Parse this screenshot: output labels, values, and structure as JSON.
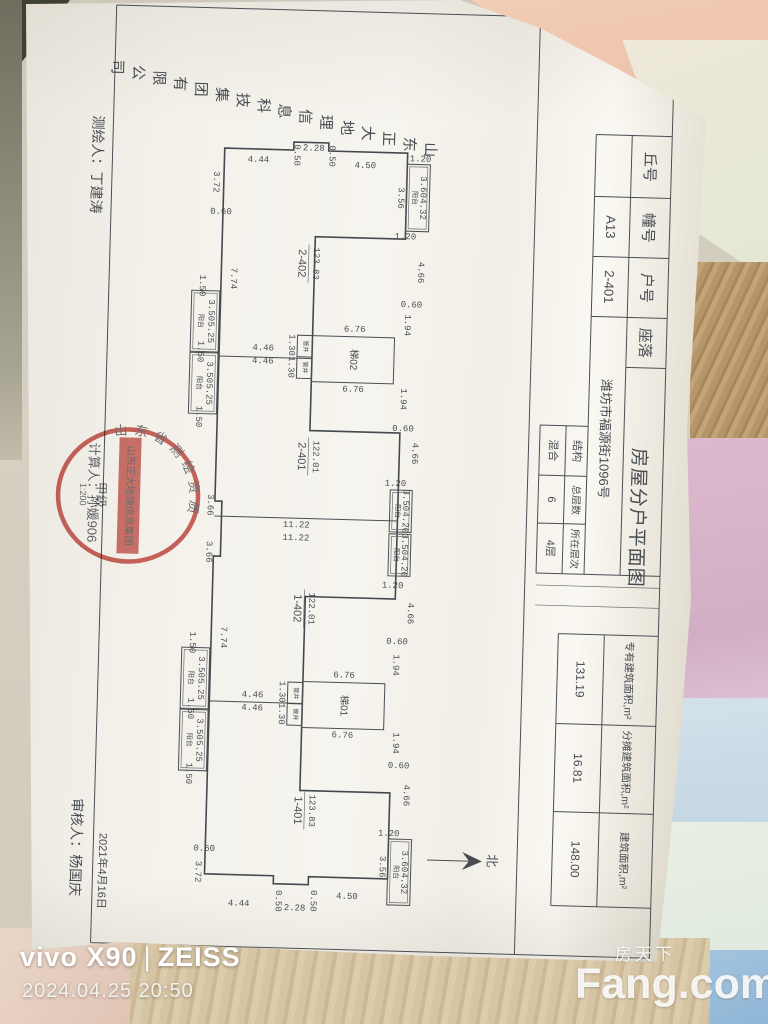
{
  "photo": {
    "camera_watermark_brand": "vivo X90",
    "camera_watermark_lens": "ZEISS",
    "timestamp": "2024.04.25 20:50",
    "site_watermark_cn": "房天下",
    "site_watermark_en": "Fang.com"
  },
  "colors": {
    "stamp_red": "#bf3a33",
    "paper": "#f4f2ec",
    "ink": "#474c52",
    "fabric": [
      "#f2cdb6",
      "#e4e7d4",
      "#b5966a",
      "#d8b5c9",
      "#cddfe9",
      "#e4ebdf",
      "#d6c4a2",
      "#a3c4de"
    ]
  },
  "doc": {
    "title": "房屋分户平面图",
    "company": "山东正大地理信息科技集团有限公司",
    "surveyor": "测绘人：丁建涛",
    "calculator": "计算人：孙媛906",
    "reviewer": "审核人：杨国庆",
    "review_date": "2021年4月16日",
    "header": {
      "fields": [
        {
          "label": "丘号",
          "value": ""
        },
        {
          "label": "幢号",
          "value": "A13"
        },
        {
          "label": "户号",
          "value": "2-401"
        },
        {
          "label": "座落",
          "value": "潍坊市福源街1096号"
        }
      ],
      "building_fields": [
        {
          "label": "结构",
          "value": "混合"
        },
        {
          "label": "总层数",
          "value": "6"
        },
        {
          "label": "所在层次",
          "value": "4层"
        }
      ],
      "area_fields": [
        {
          "label": "专有建筑面积,m²",
          "value": "131.19"
        },
        {
          "label": "分摊建筑面积,m²",
          "value": "16.81"
        },
        {
          "label": "建筑面积,m²",
          "value": "148.00"
        }
      ]
    },
    "stamp": {
      "rim_text": "山东省测绘资质",
      "banner": "山东正大地理信息集团",
      "grade": "甲级",
      "scale": "1:200"
    },
    "plan": {
      "north_label": "北",
      "balcony_label": "阳台",
      "shaft_label": "管井",
      "stairs": [
        {
          "label": "梯02",
          "x": 308,
          "y": 337
        },
        {
          "label": "梯01",
          "x": 308,
          "y": 683
        }
      ],
      "shafts": [
        {
          "x": 293,
          "y": 337
        },
        {
          "x": 293,
          "y": 684
        }
      ],
      "units": [
        {
          "no": "2-402",
          "area": "123.83",
          "x": 295,
          "ax": 309,
          "y": 265
        },
        {
          "no": "2-401",
          "area": "122.01",
          "x": 300,
          "ax": 314,
          "y": 458
        },
        {
          "no": "1-402",
          "area": "122.01",
          "x": 300,
          "ax": 314,
          "y": 610
        },
        {
          "no": "1-401",
          "area": "123.83",
          "x": 306,
          "ax": 320,
          "y": 812
        }
      ],
      "balconies": [
        {
          "x": 398,
          "y": 163,
          "w": 23,
          "h": 67,
          "dim": "3.60",
          "area": "4.32"
        },
        {
          "x": 390,
          "y": 489,
          "w": 22,
          "h": 42,
          "dim": "3.50",
          "area": "4.20"
        },
        {
          "x": 390,
          "y": 533,
          "w": 22,
          "h": 42,
          "dim": "3.50",
          "area": "4.20"
        },
        {
          "x": 398,
          "y": 838,
          "w": 23,
          "h": 66,
          "dim": "3.60",
          "area": "4.32"
        },
        {
          "x": 186,
          "y": 295,
          "w": 28,
          "h": 61,
          "dim": "3.50",
          "area": "5.25"
        },
        {
          "x": 186,
          "y": 357,
          "w": 28,
          "h": 61,
          "dim": "3.50",
          "area": "5.25"
        },
        {
          "x": 186,
          "y": 652,
          "w": 28,
          "h": 61,
          "dim": "3.50",
          "area": "5.25"
        },
        {
          "x": 186,
          "y": 714,
          "w": 28,
          "h": 61,
          "dim": "3.50",
          "area": "5.25"
        }
      ],
      "dims": [
        [
          "4.44",
          249,
          163,
          0
        ],
        [
          "0.50",
          287,
          157,
          1
        ],
        [
          "2.28",
          304,
          150,
          0
        ],
        [
          "0.50",
          322,
          157,
          1
        ],
        [
          "4.50",
          356,
          166,
          0
        ],
        [
          "3.72",
          207,
          186,
          1
        ],
        [
          "0.60",
          213,
          216,
          0
        ],
        [
          "3.56",
          392,
          197,
          1
        ],
        [
          "1.20",
          411,
          158,
          0
        ],
        [
          "1.20",
          398,
          236,
          0
        ],
        [
          "4.66",
          414,
          271,
          1
        ],
        [
          "0.60",
          406,
          304,
          0
        ],
        [
          "1.94",
          402,
          324,
          1
        ],
        [
          "6.76",
          350,
          330,
          0
        ],
        [
          "6.76",
          350,
          390,
          0
        ],
        [
          "1.94",
          400,
          398,
          1
        ],
        [
          "0.60",
          401,
          428,
          0
        ],
        [
          "4.66",
          413,
          452,
          1
        ],
        [
          "1.20",
          395,
          483,
          0
        ],
        [
          "1.30",
          287,
          347,
          1
        ],
        [
          "1.30",
          287,
          369,
          1
        ],
        [
          "4.46",
          259,
          351,
          0
        ],
        [
          "4.46",
          259,
          364,
          0
        ],
        [
          "1.50",
          196,
          290,
          1
        ],
        [
          "1.50",
          196,
          356,
          1
        ],
        [
          "1.50",
          196,
          421,
          1
        ],
        [
          "7.74",
          227,
          282,
          1
        ],
        [
          "3.66",
          210,
          509,
          1
        ],
        [
          "11.22",
          297,
          527,
          0
        ],
        [
          "11.22",
          297,
          540,
          0
        ],
        [
          "3.66",
          210,
          556,
          1
        ],
        [
          "1.20",
          395,
          585,
          0
        ],
        [
          "4.66",
          413,
          612,
          1
        ],
        [
          "0.60",
          401,
          641,
          0
        ],
        [
          "1.94",
          400,
          664,
          1
        ],
        [
          "6.76",
          349,
          676,
          0
        ],
        [
          "6.76",
          349,
          736,
          0
        ],
        [
          "1.94",
          402,
          742,
          1
        ],
        [
          "0.60",
          406,
          765,
          0
        ],
        [
          "4.66",
          414,
          794,
          1
        ],
        [
          "1.20",
          398,
          833,
          0
        ],
        [
          "3.56",
          392,
          866,
          1
        ],
        [
          "1.30",
          287,
          694,
          1
        ],
        [
          "1.30",
          287,
          716,
          1
        ],
        [
          "4.46",
          258,
          698,
          0
        ],
        [
          "4.46",
          258,
          711,
          0
        ],
        [
          "1.50",
          196,
          647,
          1
        ],
        [
          "1.50",
          196,
          713,
          1
        ],
        [
          "1.50",
          196,
          778,
          1
        ],
        [
          "7.74",
          227,
          641,
          1
        ],
        [
          "4.50",
          358,
          897,
          0
        ],
        [
          "0.50",
          324,
          902,
          1
        ],
        [
          "2.28",
          306,
          910,
          0
        ],
        [
          "0.50",
          289,
          903,
          1
        ],
        [
          "4.44",
          250,
          907,
          0
        ],
        [
          "0.60",
          214,
          853,
          0
        ],
        [
          "3.72",
          208,
          876,
          1
        ]
      ]
    }
  }
}
